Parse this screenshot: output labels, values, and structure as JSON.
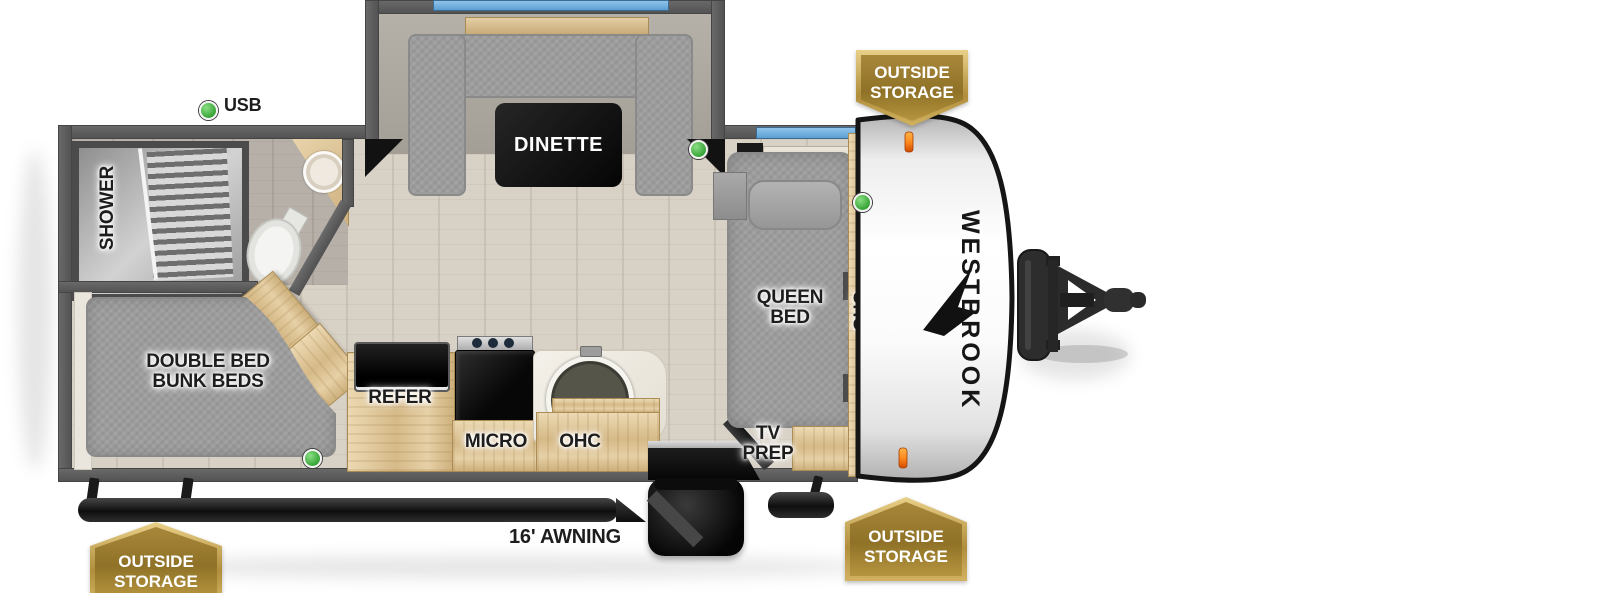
{
  "diagram": {
    "type": "travel-trailer-floor-plan"
  },
  "brand": {
    "name": "WESTBROOK"
  },
  "labels": {
    "shower": "SHOWER",
    "dinette": "DINETTE",
    "queen_line1": "QUEEN",
    "queen_line2": "BED",
    "bunk_line1": "DOUBLE BED",
    "bunk_line2": "BUNK BEDS",
    "refer": "REFER",
    "micro": "MICRO",
    "ohc_kitchen": "OHC",
    "ohc_front": "OHC",
    "tv_line1": "TV",
    "tv_line2": "PREP",
    "usb": "USB",
    "awning": "16' AWNING"
  },
  "badges": [
    {
      "position": "top-right",
      "line1": "OUTSIDE",
      "line2": "STORAGE"
    },
    {
      "position": "bottom-right",
      "line1": "OUTSIDE",
      "line2": "STORAGE"
    },
    {
      "position": "bottom-left",
      "line1": "OUTSIDE",
      "line2": "STORAGE"
    }
  ],
  "indicators": {
    "green_dot_count": 4
  },
  "colors": {
    "badge_gold": "#b3923f",
    "badge_gold_dark": "#8f7227",
    "badge_frame": "#e9d088",
    "indicator_green": "#35a335",
    "window_blue": "#70b2e2",
    "wall_gray": "#5c5c5c",
    "wood": "#dfc8a0",
    "fabric_gray": "#9d9d9d"
  }
}
